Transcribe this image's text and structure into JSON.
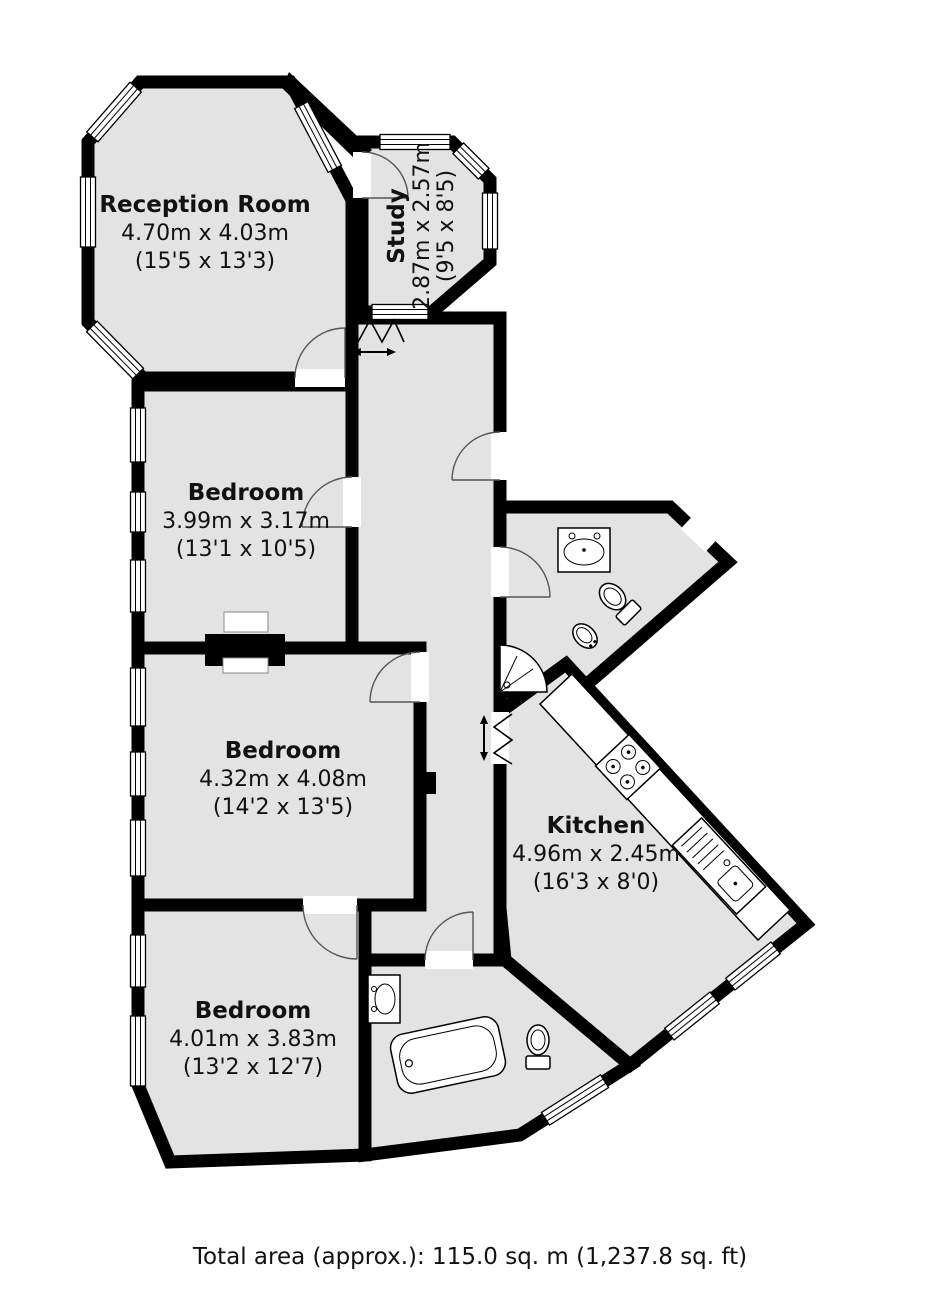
{
  "plan": {
    "rooms": [
      {
        "id": "reception",
        "name": "Reception Room",
        "size_metric": "4.70m x 4.03m",
        "size_imperial": "(15'5 x 13'3)"
      },
      {
        "id": "study",
        "name": "Study",
        "size_metric": "2.87m x 2.57m",
        "size_imperial": "(9'5 x 8'5)"
      },
      {
        "id": "bedroom-1",
        "name": "Bedroom",
        "size_metric": "3.99m x 3.17m",
        "size_imperial": "(13'1 x 10'5)"
      },
      {
        "id": "bedroom-2",
        "name": "Bedroom",
        "size_metric": "4.32m x 4.08m",
        "size_imperial": "(14'2 x 13'5)"
      },
      {
        "id": "kitchen",
        "name": "Kitchen",
        "size_metric": "4.96m x 2.45m",
        "size_imperial": "(16'3 x 8'0)"
      },
      {
        "id": "bedroom-3",
        "name": "Bedroom",
        "size_metric": "4.01m x 3.83m",
        "size_imperial": "(13'2 x 12'7)"
      }
    ],
    "footer_text": "Total area (approx.): 115.0 sq. m (1,237.8 sq. ft)",
    "fixture_icons": [
      "bathtub",
      "shower",
      "toilet",
      "bidet",
      "basin",
      "hob",
      "sink-drainer",
      "window",
      "door-arc",
      "folding-door"
    ],
    "colors": {
      "wall": "#000000",
      "floor": "#e3e3e3",
      "background": "#ffffff",
      "text": "#111111"
    }
  }
}
